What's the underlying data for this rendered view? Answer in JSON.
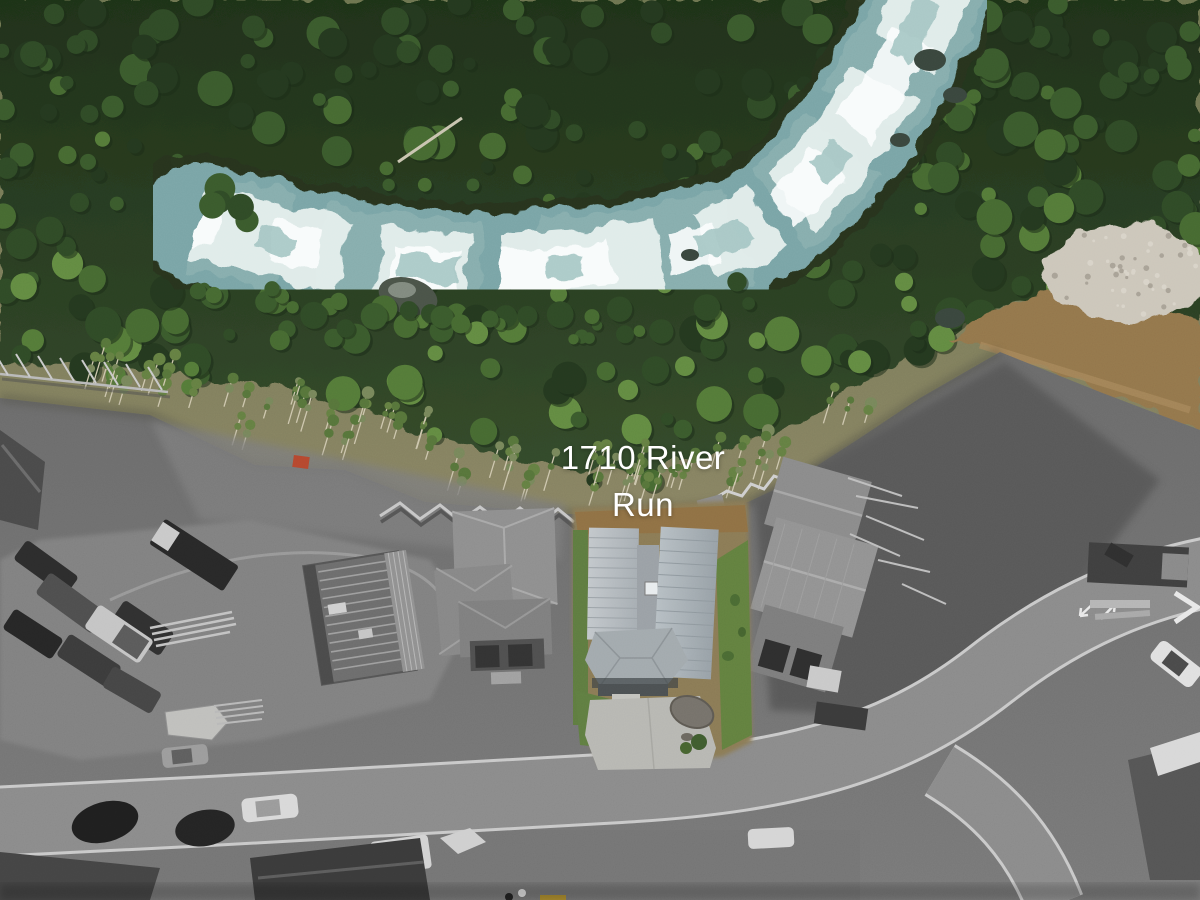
{
  "photo": {
    "kind": "aerial-drone-real-estate-photo",
    "label": {
      "line1": "1710 River",
      "line2": "Run",
      "full": "1710 River Run"
    },
    "palette": {
      "forest_green_dark": "#24381f",
      "forest_green_mid": "#3a5a2c",
      "forest_green_light": "#628a41",
      "river_teal": "#79a4a6",
      "river_foam": "#e8f1ef",
      "rocky_bank": "#ccc6ba",
      "dirt_road_brown": "#93764c",
      "lot_grass": "#5f7d41",
      "lot_dirt": "#8a6e49",
      "metal_roof": "#aeb6bb",
      "site_gray": "#6f6f6f",
      "road_gray": "#8a8a8a",
      "curb_white": "#cfcfcf",
      "label_text": "#ffffff",
      "red_marker": "#b5472e"
    }
  }
}
